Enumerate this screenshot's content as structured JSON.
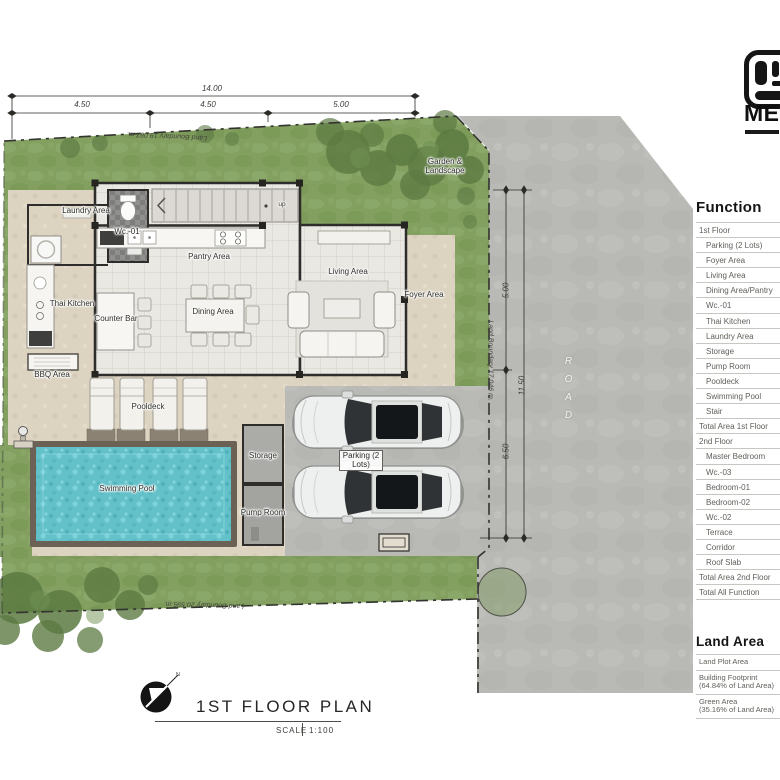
{
  "palette": {
    "grass": "#83a061",
    "road": "#b9b9b6",
    "patio": "#dcd3c1",
    "pool_water": "#63c1c9",
    "wall": "#2e2d2b",
    "table_text": "#5f5f5a"
  },
  "logo": {
    "text": "ME"
  },
  "dimensions": {
    "top_total": "14.00",
    "top_segments": [
      "4.50",
      "4.50",
      "5.00"
    ],
    "right_total": "11.50",
    "right_segments": [
      "5.00",
      "6.50"
    ]
  },
  "boundaries": {
    "top": "Land Boundary 19.087 m.",
    "right": "Land Boundary 17.046 m.",
    "bottom": "Land Boundary 20.595 m."
  },
  "road": {
    "label": "ROAD"
  },
  "rooms": {
    "laundry": "Laundry Area",
    "wc01": "Wc.-01",
    "pantry": "Pantry Area",
    "thai_kitchen": "Thai Kitchen",
    "counter_bar": "Counter Bar",
    "bbq": "BBQ Area",
    "dining": "Dining Area",
    "living": "Living Area",
    "foyer": "Foyer Area",
    "garden": "Garden & Landscape",
    "pooldeck": "Pooldeck",
    "swimming_pool": "Swimming Pool",
    "storage": "Storage",
    "pump_room": "Pump Room",
    "parking": "Parking (2 Lots)",
    "stair_up": "up"
  },
  "function_table": {
    "title": "Function",
    "rows": [
      {
        "label": "1st Floor",
        "indent": false
      },
      {
        "label": "Parking (2 Lots)",
        "indent": true
      },
      {
        "label": "Foyer Area",
        "indent": true
      },
      {
        "label": "Living Area",
        "indent": true
      },
      {
        "label": "Dining Area/Pantry",
        "indent": true
      },
      {
        "label": "Wc.-01",
        "indent": true
      },
      {
        "label": "Thai Kitchen",
        "indent": true
      },
      {
        "label": "Laundry Area",
        "indent": true
      },
      {
        "label": "Storage",
        "indent": true
      },
      {
        "label": "Pump Room",
        "indent": true
      },
      {
        "label": "Pooldeck",
        "indent": true
      },
      {
        "label": "Swimming Pool",
        "indent": true
      },
      {
        "label": "Stair",
        "indent": true
      },
      {
        "label": "Total Area 1st Floor",
        "indent": false
      },
      {
        "label": "2nd Floor",
        "indent": false
      },
      {
        "label": "Master Bedroom",
        "indent": true
      },
      {
        "label": "Wc.-03",
        "indent": true
      },
      {
        "label": "Bedroom-01",
        "indent": true
      },
      {
        "label": "Bedroom-02",
        "indent": true
      },
      {
        "label": "Wc.-02",
        "indent": true
      },
      {
        "label": "Terrace",
        "indent": true
      },
      {
        "label": "Corridor",
        "indent": true
      },
      {
        "label": "Roof Slab",
        "indent": true
      },
      {
        "label": "Total Area 2nd Floor",
        "indent": false
      },
      {
        "label": "Total All Function",
        "indent": false
      }
    ]
  },
  "land_table": {
    "title": "Land Area",
    "rows": [
      {
        "label": "Land Plot Area",
        "sub": ""
      },
      {
        "label": "Building Footprint",
        "sub": "(64.84% of Land Area)"
      },
      {
        "label": "Green Area",
        "sub": "(35.16% of Land Area)"
      }
    ]
  },
  "titleblock": {
    "title": "1ST FLOOR PLAN",
    "scale_label": "SCALE",
    "scale_value": "1:100",
    "north": "N"
  }
}
